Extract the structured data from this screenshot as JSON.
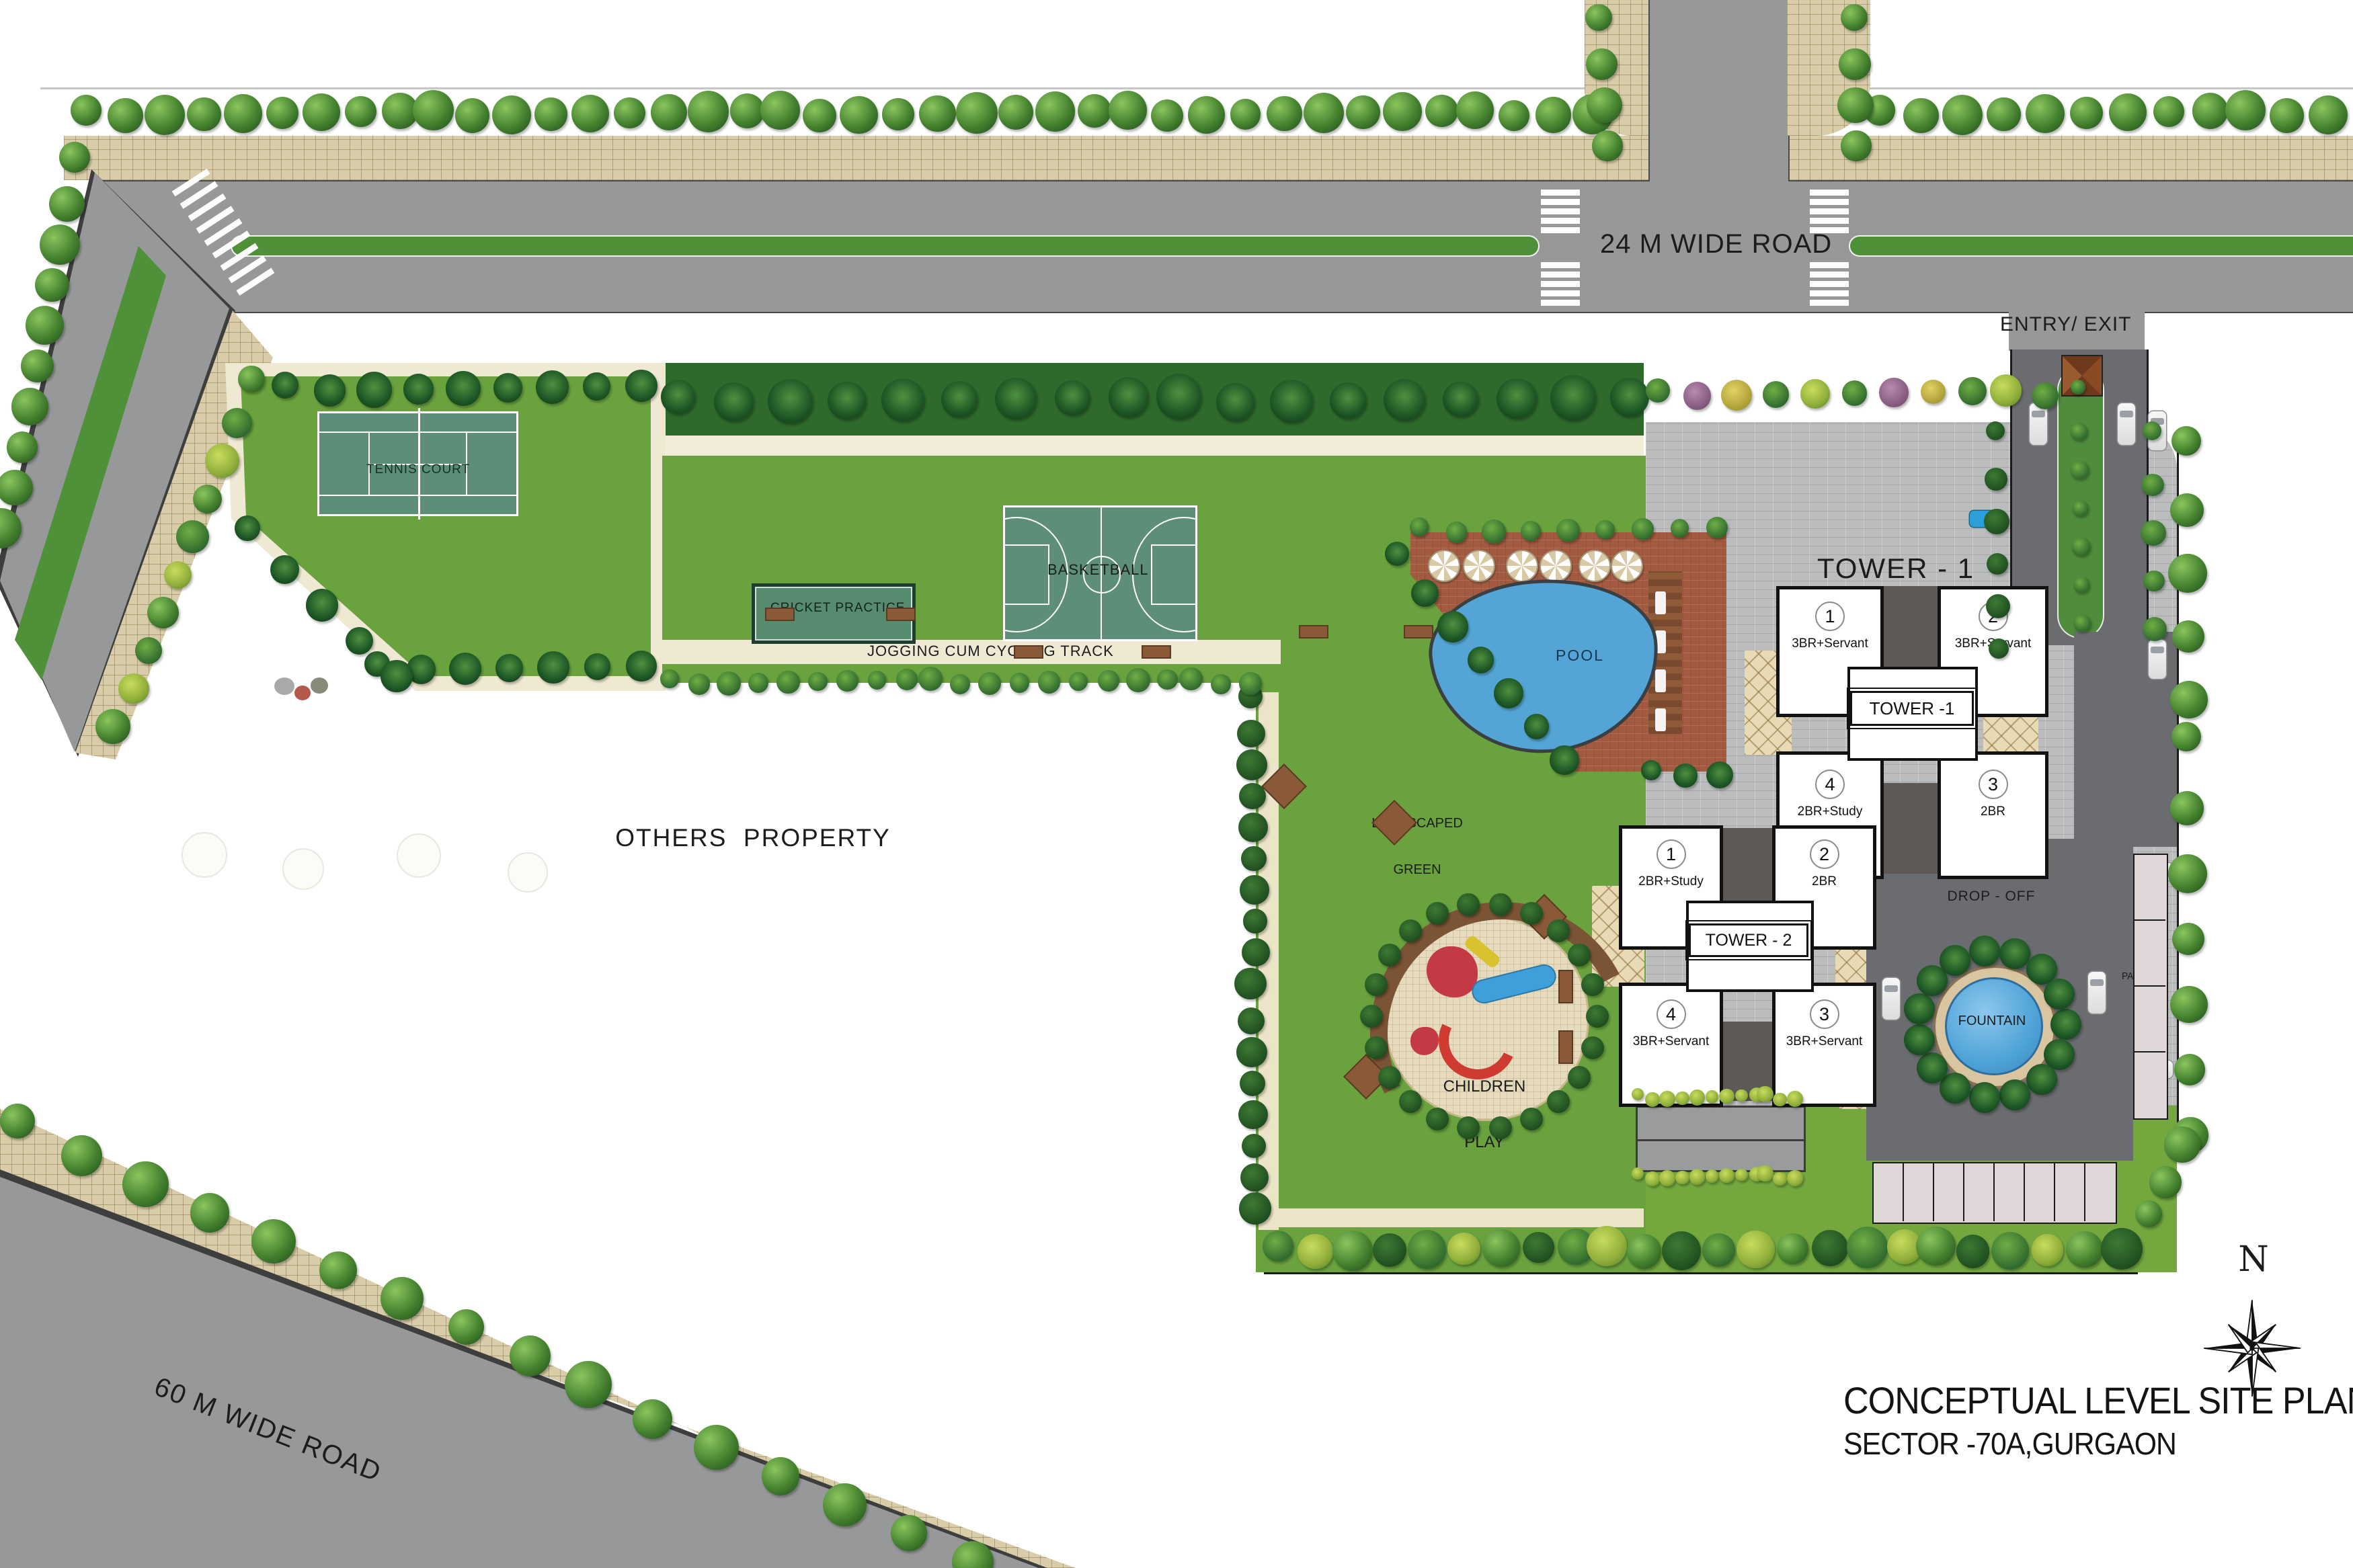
{
  "meta": {
    "title_line1": "CONCEPTUAL LEVEL SITE PLAN",
    "title_line2": "SECTOR -70A,GURGAON",
    "compass_n": "N"
  },
  "roads": {
    "top_label": "24 M WIDE ROAD",
    "bottom_label": "60 M WIDE ROAD",
    "entry_label": "ENTRY/ EXIT"
  },
  "areas": {
    "others_property": "OTHERS  PROPERTY",
    "landscaped_green_1": "LANDSCAPED",
    "landscaped_green_2": "GREEN",
    "children_play_1": "CHILDREN",
    "children_play_2": "PLAY",
    "pool": "POOL",
    "fountain": "FOUNTAIN",
    "drop_off": "DROP - OFF",
    "parking": "PARKING",
    "tennis": "TENNIS COURT",
    "cricket": "CRICKET PRACTICE",
    "basketball": "BASKETBALL",
    "jogging": "JOGGING CUM CYCLING TRACK"
  },
  "tower1": {
    "heading": "TOWER - 1",
    "core": "TOWER -1",
    "units": [
      {
        "no": "1",
        "type": "3BR+Servant"
      },
      {
        "no": "2",
        "type": "3BR+Servant"
      },
      {
        "no": "4",
        "type": "2BR+Study"
      },
      {
        "no": "3",
        "type": "2BR"
      }
    ]
  },
  "tower2": {
    "core": "TOWER - 2",
    "units": [
      {
        "no": "1",
        "type": "2BR+Study"
      },
      {
        "no": "2",
        "type": "2BR"
      },
      {
        "no": "4",
        "type": "3BR+Servant"
      },
      {
        "no": "3",
        "type": "3BR+Servant"
      }
    ]
  },
  "colors": {
    "road": "#97989a",
    "internal_road": "#6a6c6f",
    "sidewalk": "#d9cda9",
    "lawn": "#6aa23e",
    "median_green": "#4e9139",
    "pool_water": "#54a5d5",
    "pool_deck": "#a25a40",
    "sport_court": "#5d8f78",
    "tower_paving": "#bbbcbe"
  }
}
